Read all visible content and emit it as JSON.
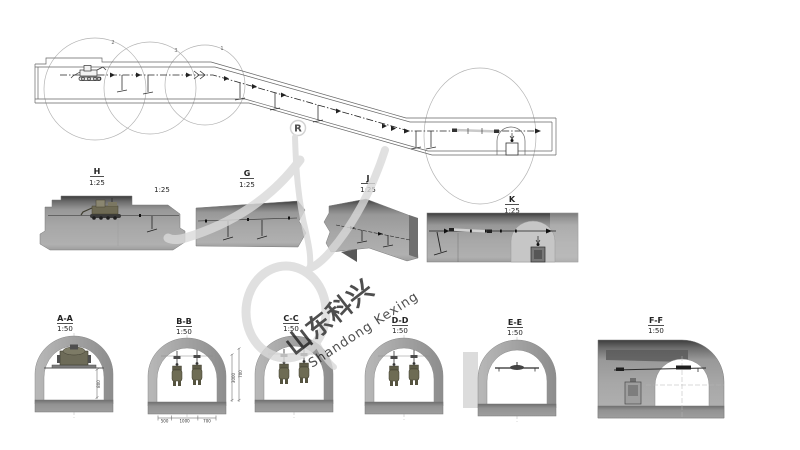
{
  "watermark": {
    "registered": "R",
    "cn": "山东科兴",
    "en": "Shandong Kexing"
  },
  "plan": {
    "callouts": [
      "2",
      "3",
      "1"
    ]
  },
  "details": {
    "h": {
      "name": "H",
      "scale": "1:25"
    },
    "g": {
      "name": "G",
      "scale": "1:25"
    },
    "j": {
      "name": "J",
      "scale": "1:25"
    },
    "k": {
      "name": "K",
      "scale": "1:25"
    },
    "extra_scale": "1:25"
  },
  "sections": {
    "aa": {
      "name": "A-A",
      "scale": "1:50",
      "dim": "800"
    },
    "bb": {
      "name": "B-B",
      "scale": "1:50",
      "dims_bottom": [
        "500",
        "1000",
        "700"
      ],
      "dims_right": [
        "3000",
        "700"
      ]
    },
    "cc": {
      "name": "C-C",
      "scale": "1:50"
    },
    "dd": {
      "name": "D-D",
      "scale": "1:50"
    },
    "ee": {
      "name": "E-E",
      "scale": "1:50"
    },
    "ff": {
      "name": "F-F",
      "scale": "1:50"
    }
  },
  "colors": {
    "paper": "#ffffff",
    "line": "#555555",
    "section_gray": "#a8a8a8",
    "slab_gray": "#8f8f8f",
    "dark_band": "#3c3c3c",
    "device_olive": "#6e6c54",
    "watermark_gray": "#d9d9d9",
    "watermark_pink": "#f4c9bf"
  }
}
